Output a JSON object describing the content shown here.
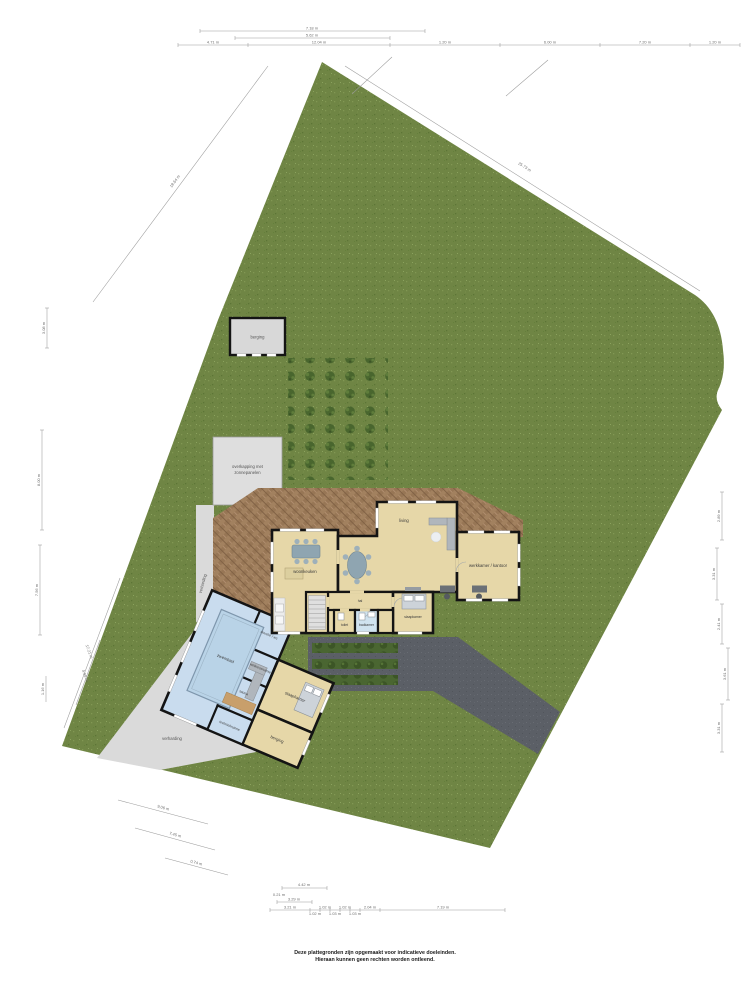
{
  "disclaimer": {
    "line1": "Deze plattegronden zijn opgemaakt voor indicatieve doeleinden.",
    "line2": "Hieraan kunnen geen rechten worden ontleend."
  },
  "site": {
    "shed_label": "berging",
    "carport_label_1": "overkapping met",
    "carport_label_2": "zonnepanelen",
    "paving_label_left": "verharding",
    "paving_label_bottom": "verharding"
  },
  "house": {
    "rooms": {
      "living": "living",
      "kitchen": "woonkeuken",
      "office": "werkkamer / kantoor",
      "hall": "hal",
      "bedroom": "slaapkamer",
      "bathroom": "badkamer",
      "toilet": "toilet"
    }
  },
  "pool_wing": {
    "rooms": {
      "pool": "zwembad",
      "wellness": "wellnessruimte",
      "shower_wc": "douche / wc",
      "sauna": "sauna",
      "tech": "techniekruimte",
      "bedroom": "slaapkamer",
      "storage": "berging"
    }
  },
  "dimensions": {
    "top": [
      "7.18 m",
      "5.62 m",
      "4.71 m",
      "12.04 m",
      "1.20 m",
      "6.00 m",
      "7.20 m",
      "1.20 m"
    ],
    "left": [
      "3.08 m",
      "8.00 m",
      "7.56 m",
      "1.16 m",
      "17.21 m",
      "4.96 m",
      "18.64 m"
    ],
    "right": [
      "25.73 m",
      "2.89 m",
      "3.31 m",
      "2.41 m",
      "3.61 m",
      "3.31 m"
    ],
    "bottom": [
      "4.42 m",
      "0.21 m",
      "3.29 m",
      "3.21 m",
      "1.02 m",
      "1.02 m",
      "1.03 m",
      "1.02 m",
      "1.03 m",
      "2.04 m",
      "7.19 m"
    ],
    "bottom_left": [
      "9.06 m",
      "7.45 m",
      "0.74 m"
    ]
  },
  "colors": {
    "grass": "#6f8544",
    "terrace": "#a2815f",
    "driveway": "#5b5f66",
    "paving": "#dadada",
    "shed": "#d8d8d8",
    "house_floor": "#e6d7a8",
    "pool_floor": "#c9dcee",
    "pool_water": "#b9d3e7",
    "wall": "#141414"
  }
}
